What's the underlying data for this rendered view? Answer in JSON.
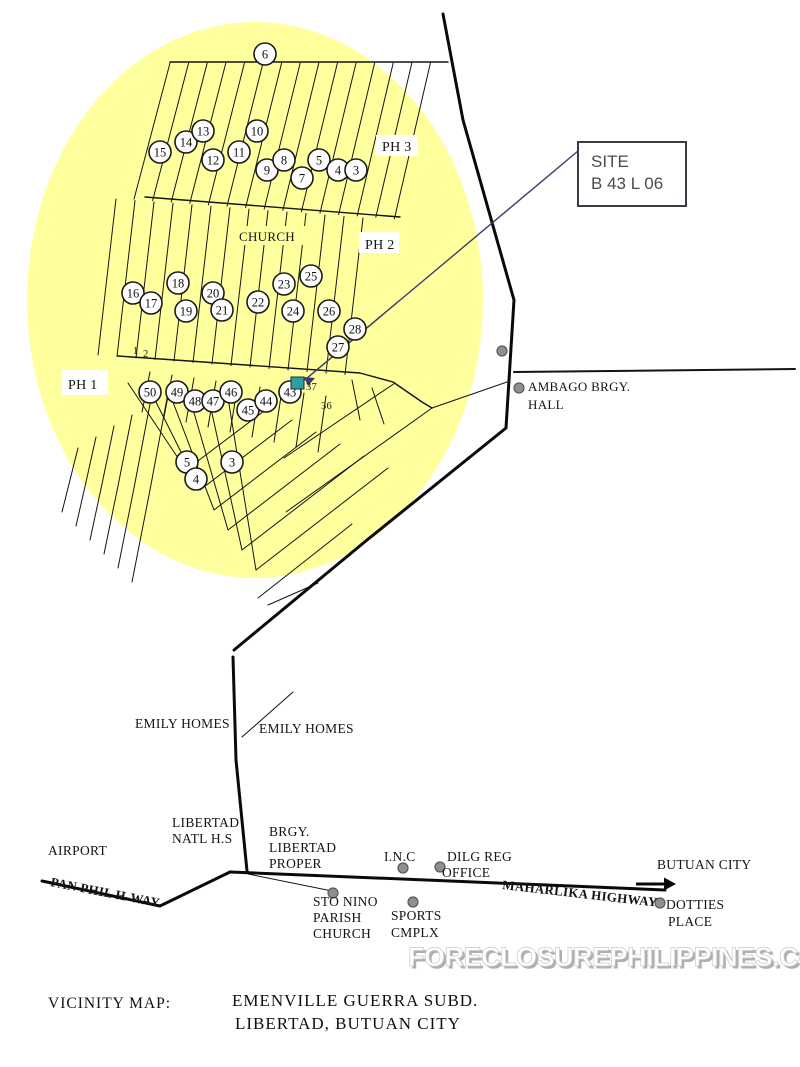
{
  "map": {
    "colors": {
      "area_fill": "#ffff9e",
      "line": "#141414",
      "road": "#0a0a0a",
      "marker_fill": "#fefefe",
      "site_marker": "#2f9e9e",
      "site_marker_border": "#1d2a4a",
      "pointer": "#3c3c6e",
      "poi_dot_fill": "#8f8f8f",
      "poi_dot_border": "#5a5a5a"
    },
    "site_callout": {
      "line1": "SITE",
      "line2": "B 43 L 06"
    },
    "area_labels": [
      {
        "id": "ph-3",
        "text": "PH 3",
        "x": 382,
        "y": 151,
        "size": 14,
        "bg": {
          "x": 376,
          "y": 135,
          "w": 42,
          "h": 21,
          "fill": "#ffffff"
        }
      },
      {
        "id": "church",
        "text": "CHURCH",
        "x": 239,
        "y": 241,
        "size": 13,
        "bg": {
          "x": 233,
          "y": 226,
          "w": 72,
          "h": 19,
          "fill": "#ffff9e"
        }
      },
      {
        "id": "ph-2",
        "text": "PH 2",
        "x": 365,
        "y": 249,
        "size": 14,
        "bg": {
          "x": 359,
          "y": 232,
          "w": 40,
          "h": 21,
          "fill": "#ffffff"
        }
      },
      {
        "id": "ph-1",
        "text": "PH 1",
        "x": 68,
        "y": 389,
        "size": 14,
        "bg": {
          "x": 62,
          "y": 370,
          "w": 46,
          "h": 25,
          "fill": "#ffffff"
        }
      },
      {
        "id": "ambago-brgy-line1",
        "text": "AMBAGO BRGY.",
        "x": 528,
        "y": 391,
        "size": 13
      },
      {
        "id": "ambago-brgy-line2",
        "text": "HALL",
        "x": 528,
        "y": 409,
        "size": 13
      },
      {
        "id": "emily-homes-left",
        "text": "EMILY HOMES",
        "x": 135,
        "y": 728,
        "size": 13.5
      },
      {
        "id": "emily-homes-right",
        "text": "EMILY HOMES",
        "x": 259,
        "y": 733,
        "size": 13.5
      },
      {
        "id": "libertad-natl-hs-line1",
        "text": "LIBERTAD",
        "x": 172,
        "y": 827,
        "size": 13.5
      },
      {
        "id": "libertad-natl-hs-line2",
        "text": "NATL H.S",
        "x": 172,
        "y": 843,
        "size": 13.5
      },
      {
        "id": "brgy-libertad-line1",
        "text": "BRGY.",
        "x": 269,
        "y": 836,
        "size": 13.5
      },
      {
        "id": "brgy-libertad-line2",
        "text": "LIBERTAD",
        "x": 269,
        "y": 852,
        "size": 13.5
      },
      {
        "id": "brgy-libertad-line3",
        "text": "PROPER",
        "x": 269,
        "y": 868,
        "size": 13.5
      },
      {
        "id": "airport",
        "text": "AIRPORT",
        "x": 48,
        "y": 855,
        "size": 13.5
      },
      {
        "id": "pan-phil-hway",
        "text": "PAN PHIL H-WAY",
        "x": 50,
        "y": 886,
        "size": 13,
        "bold": true,
        "rotate": 11
      },
      {
        "id": "inc",
        "text": "I.N.C",
        "x": 384,
        "y": 861,
        "size": 13.5
      },
      {
        "id": "dilg-reg-line1",
        "text": "DILG REG",
        "x": 447,
        "y": 861,
        "size": 13.5
      },
      {
        "id": "dilg-reg-line2",
        "text": "OFFICE",
        "x": 442,
        "y": 877,
        "size": 13.5
      },
      {
        "id": "maharlika-highway",
        "text": "MAHARLIKA HIGHWAY",
        "x": 502,
        "y": 889,
        "size": 13,
        "bold": true,
        "rotate": 6.5
      },
      {
        "id": "butuan-city",
        "text": "BUTUAN CITY",
        "x": 657,
        "y": 869,
        "size": 13.5
      },
      {
        "id": "dotties-place-line1",
        "text": "DOTTIES",
        "x": 666,
        "y": 909,
        "size": 13.5
      },
      {
        "id": "dotties-place-line2",
        "text": "PLACE",
        "x": 668,
        "y": 926,
        "size": 13.5
      },
      {
        "id": "sto-nino-line1",
        "text": "STO NINO",
        "x": 313,
        "y": 906,
        "size": 13.5
      },
      {
        "id": "sto-nino-line2",
        "text": "PARISH",
        "x": 313,
        "y": 922,
        "size": 13.5
      },
      {
        "id": "sto-nino-line3",
        "text": "CHURCH",
        "x": 313,
        "y": 938,
        "size": 13.5
      },
      {
        "id": "sports-cmplx-line1",
        "text": "SPORTS",
        "x": 391,
        "y": 920,
        "size": 13.5
      },
      {
        "id": "sports-cmplx-line2",
        "text": "CMPLX",
        "x": 391,
        "y": 937,
        "size": 13.5
      }
    ],
    "small_numbers": [
      {
        "text": "1",
        "x": 133,
        "y": 354
      },
      {
        "text": "2",
        "x": 143,
        "y": 357
      },
      {
        "text": "37",
        "x": 306,
        "y": 390
      },
      {
        "text": "36",
        "x": 321,
        "y": 409
      }
    ],
    "lot_markers": [
      {
        "n": "6",
        "x": 265,
        "y": 54
      },
      {
        "n": "15",
        "x": 160,
        "y": 152
      },
      {
        "n": "14",
        "x": 186,
        "y": 142
      },
      {
        "n": "13",
        "x": 203,
        "y": 131
      },
      {
        "n": "12",
        "x": 213,
        "y": 160
      },
      {
        "n": "11",
        "x": 239,
        "y": 152
      },
      {
        "n": "10",
        "x": 257,
        "y": 131
      },
      {
        "n": "9",
        "x": 267,
        "y": 170
      },
      {
        "n": "8",
        "x": 284,
        "y": 160
      },
      {
        "n": "7",
        "x": 302,
        "y": 178
      },
      {
        "n": "5",
        "x": 319,
        "y": 160
      },
      {
        "n": "4",
        "x": 338,
        "y": 170
      },
      {
        "n": "3",
        "x": 356,
        "y": 170
      },
      {
        "n": "16",
        "x": 133,
        "y": 293
      },
      {
        "n": "17",
        "x": 151,
        "y": 303
      },
      {
        "n": "18",
        "x": 178,
        "y": 283
      },
      {
        "n": "19",
        "x": 186,
        "y": 311
      },
      {
        "n": "20",
        "x": 213,
        "y": 293
      },
      {
        "n": "21",
        "x": 222,
        "y": 310
      },
      {
        "n": "22",
        "x": 258,
        "y": 302
      },
      {
        "n": "23",
        "x": 284,
        "y": 284
      },
      {
        "n": "24",
        "x": 293,
        "y": 311
      },
      {
        "n": "25",
        "x": 311,
        "y": 276
      },
      {
        "n": "26",
        "x": 329,
        "y": 311
      },
      {
        "n": "27",
        "x": 338,
        "y": 347
      },
      {
        "n": "28",
        "x": 355,
        "y": 329
      },
      {
        "n": "50",
        "x": 150,
        "y": 392
      },
      {
        "n": "49",
        "x": 177,
        "y": 392
      },
      {
        "n": "48",
        "x": 195,
        "y": 401
      },
      {
        "n": "47",
        "x": 213,
        "y": 401
      },
      {
        "n": "46",
        "x": 231,
        "y": 392
      },
      {
        "n": "45",
        "x": 248,
        "y": 410
      },
      {
        "n": "44",
        "x": 266,
        "y": 401
      },
      {
        "n": "43",
        "x": 290,
        "y": 392
      },
      {
        "n": "5",
        "x": 187,
        "y": 462
      },
      {
        "n": "3",
        "x": 232,
        "y": 462
      },
      {
        "n": "4",
        "x": 196,
        "y": 479
      }
    ],
    "poi_dots": [
      {
        "x": 502,
        "y": 351
      },
      {
        "x": 519,
        "y": 388
      },
      {
        "x": 403,
        "y": 868
      },
      {
        "x": 440,
        "y": 867
      },
      {
        "x": 333,
        "y": 893
      },
      {
        "x": 413,
        "y": 902
      },
      {
        "x": 660,
        "y": 903
      }
    ],
    "watermark": "FORECLOSUREPHILIPPINES.COM",
    "caption": {
      "label": "VICINITY MAP:",
      "line1": "EMENVILLE GUERRA SUBD.",
      "line2": "LIBERTAD, BUTUAN CITY"
    }
  }
}
